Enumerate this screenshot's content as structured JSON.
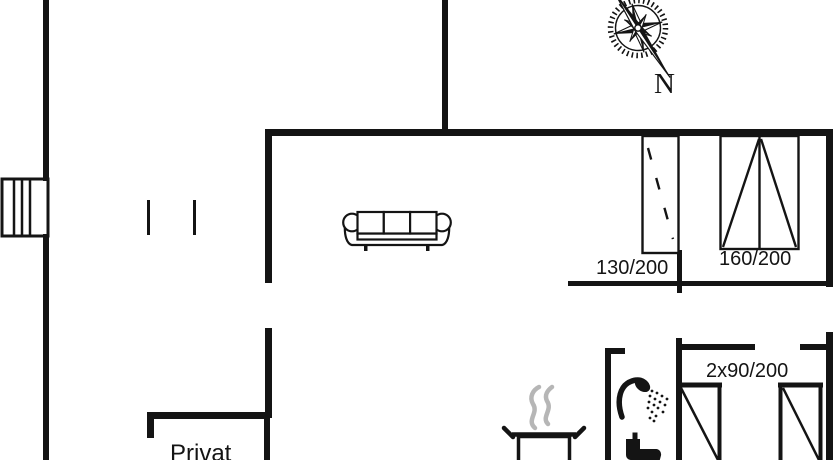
{
  "palette": {
    "ink": "#141414",
    "paper": "#ffffff",
    "steam": "#b6b6b6"
  },
  "compass": {
    "direction_label": "N"
  },
  "labels": {
    "window_small": "130/200",
    "window_large": "160/200",
    "double_doors": "2x90/200",
    "private_room": "Privat"
  },
  "icons": {
    "compass": "compass-rose-icon",
    "sofa": "sofa-icon",
    "shower": "shower-icon",
    "toilet": "toilet-icon",
    "pot": "steaming-pot-icon",
    "chimney": "chimney-icon",
    "window_small": "window-sliding-icon",
    "window_large": "window-double-casement-icon",
    "doors": "double-door-elevation-icon"
  }
}
